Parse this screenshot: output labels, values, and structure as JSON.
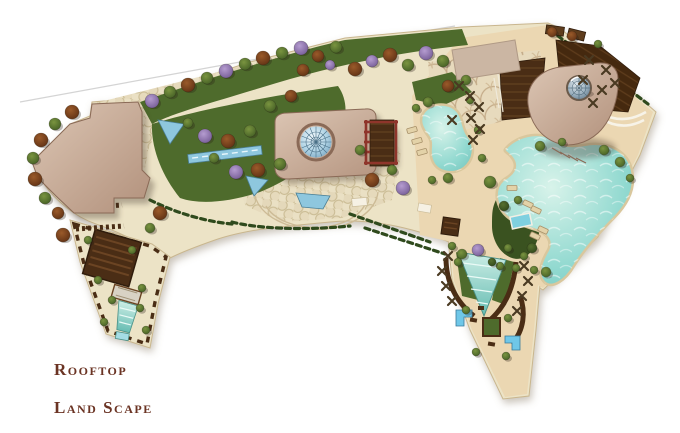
{
  "title": {
    "line1": "Rooftop",
    "line2": "Land Scape"
  },
  "palette": {
    "paper": "#ffffff",
    "sand_light": "#ece3c6",
    "sand_warm": "#ebd7b2",
    "edge": "#c9b68e",
    "lawn": "#4e6b2c",
    "lawn_dark": "#3a5220",
    "hedge": "#2f4a1d",
    "water_blue": "#8ec7de",
    "water_edge": "#4a7f96",
    "pool_teal": "#8fd8cf",
    "pool_rim": "#d9c79d",
    "bldg_light": "#dcc6b4",
    "bldg_dark": "#b2917c",
    "bldg_edge": "#8a6a57",
    "wood": "#4a2d15",
    "wood_dark": "#2f1c0c",
    "red_frame": "#8f352b",
    "tree_rust": "#7c4220",
    "tree_green": "#5d7531",
    "tree_purple": "#9b83bd",
    "shadow": "#3a2a20",
    "title": "#6b3424",
    "roofline": "#d4d4d4"
  },
  "scene": {
    "icon_names": {
      "tree": "tree-icon",
      "lounger": "sun-lounger-icon",
      "x_motif": "planter-cross-icon",
      "dome": "glass-dome-icon"
    },
    "trees": [
      [
        72,
        112,
        7,
        "r"
      ],
      [
        55,
        124,
        6,
        "g"
      ],
      [
        41,
        140,
        7,
        "r"
      ],
      [
        33,
        158,
        6,
        "g"
      ],
      [
        35,
        179,
        7,
        "r"
      ],
      [
        45,
        198,
        6,
        "g"
      ],
      [
        58,
        213,
        6,
        "r"
      ],
      [
        63,
        235,
        7,
        "r"
      ],
      [
        160,
        213,
        7,
        "r"
      ],
      [
        150,
        228,
        5,
        "g"
      ],
      [
        152,
        101,
        7,
        "p"
      ],
      [
        170,
        92,
        6,
        "g"
      ],
      [
        188,
        85,
        7,
        "r"
      ],
      [
        207,
        78,
        6,
        "g"
      ],
      [
        226,
        71,
        7,
        "p"
      ],
      [
        245,
        64,
        6,
        "g"
      ],
      [
        263,
        58,
        7,
        "r"
      ],
      [
        282,
        53,
        6,
        "g"
      ],
      [
        301,
        48,
        7,
        "p"
      ],
      [
        318,
        56,
        6,
        "r"
      ],
      [
        336,
        47,
        6,
        "g"
      ],
      [
        355,
        69,
        7,
        "r"
      ],
      [
        372,
        61,
        6,
        "p"
      ],
      [
        390,
        55,
        7,
        "r"
      ],
      [
        408,
        65,
        6,
        "g"
      ],
      [
        426,
        53,
        7,
        "p"
      ],
      [
        443,
        61,
        6,
        "g"
      ],
      [
        303,
        70,
        6,
        "r"
      ],
      [
        330,
        65,
        5,
        "p"
      ],
      [
        205,
        136,
        7,
        "p"
      ],
      [
        228,
        141,
        7,
        "r"
      ],
      [
        250,
        131,
        6,
        "g"
      ],
      [
        236,
        172,
        7,
        "p"
      ],
      [
        258,
        170,
        7,
        "r"
      ],
      [
        280,
        164,
        6,
        "g"
      ],
      [
        188,
        123,
        5,
        "g"
      ],
      [
        270,
        106,
        6,
        "g"
      ],
      [
        291,
        96,
        6,
        "r"
      ],
      [
        214,
        158,
        5,
        "g"
      ],
      [
        372,
        180,
        7,
        "r"
      ],
      [
        403,
        188,
        7,
        "p"
      ],
      [
        392,
        170,
        5,
        "g"
      ],
      [
        360,
        150,
        5,
        "g"
      ],
      [
        428,
        102,
        5,
        "g"
      ],
      [
        448,
        86,
        6,
        "r"
      ],
      [
        466,
        80,
        5,
        "g"
      ],
      [
        540,
        146,
        5,
        "g"
      ],
      [
        562,
        142,
        4,
        "g"
      ],
      [
        604,
        150,
        5,
        "g"
      ],
      [
        620,
        162,
        5,
        "g"
      ],
      [
        630,
        178,
        4,
        "g"
      ],
      [
        490,
        182,
        6,
        "g"
      ],
      [
        478,
        250,
        6,
        "p"
      ],
      [
        462,
        254,
        5,
        "g"
      ],
      [
        546,
        272,
        5,
        "g"
      ],
      [
        500,
        266,
        4,
        "g"
      ],
      [
        504,
        206,
        5,
        "d"
      ],
      [
        518,
        200,
        4,
        "g"
      ],
      [
        532,
        248,
        5,
        "d"
      ],
      [
        508,
        248,
        4,
        "g"
      ],
      [
        524,
        256,
        4,
        "g"
      ],
      [
        552,
        32,
        5,
        "r"
      ],
      [
        572,
        36,
        5,
        "r"
      ],
      [
        598,
        44,
        4,
        "g"
      ],
      [
        88,
        240,
        4,
        "g"
      ],
      [
        132,
        250,
        4,
        "g"
      ],
      [
        98,
        280,
        4,
        "g"
      ],
      [
        142,
        288,
        4,
        "g"
      ],
      [
        112,
        300,
        4,
        "g"
      ],
      [
        140,
        308,
        4,
        "g"
      ],
      [
        104,
        322,
        4,
        "g"
      ],
      [
        146,
        330,
        4,
        "g"
      ],
      [
        458,
        262,
        4,
        "g"
      ],
      [
        516,
        268,
        4,
        "g"
      ],
      [
        466,
        310,
        4,
        "g"
      ],
      [
        508,
        318,
        4,
        "g"
      ],
      [
        476,
        352,
        4,
        "g"
      ],
      [
        506,
        356,
        4,
        "g"
      ],
      [
        492,
        262,
        4,
        "d"
      ],
      [
        452,
        246,
        4,
        "g"
      ],
      [
        534,
        270,
        4,
        "g"
      ],
      [
        416,
        108,
        4,
        "g"
      ],
      [
        470,
        100,
        4,
        "g"
      ],
      [
        478,
        130,
        4,
        "g"
      ],
      [
        482,
        158,
        4,
        "g"
      ],
      [
        448,
        178,
        5,
        "g"
      ],
      [
        432,
        180,
        4,
        "g"
      ]
    ],
    "loungers": [
      [
        412,
        130,
        -15
      ],
      [
        417,
        141,
        -15
      ],
      [
        422,
        152,
        -15
      ],
      [
        528,
        204,
        25
      ],
      [
        536,
        210,
        25
      ],
      [
        543,
        230,
        25
      ],
      [
        535,
        236,
        25
      ],
      [
        512,
        188,
        0
      ]
    ],
    "x_motifs": [
      [
        470,
        96
      ],
      [
        479,
        107
      ],
      [
        471,
        118
      ],
      [
        480,
        129
      ],
      [
        473,
        140
      ],
      [
        459,
        86
      ],
      [
        452,
        120
      ],
      [
        589,
        60
      ],
      [
        606,
        70
      ],
      [
        583,
        80
      ],
      [
        602,
        90
      ],
      [
        593,
        103
      ],
      [
        615,
        83
      ],
      [
        448,
        256
      ],
      [
        442,
        271
      ],
      [
        446,
        286
      ],
      [
        452,
        301
      ],
      [
        524,
        266
      ],
      [
        528,
        281
      ],
      [
        522,
        296
      ],
      [
        517,
        311
      ]
    ]
  }
}
